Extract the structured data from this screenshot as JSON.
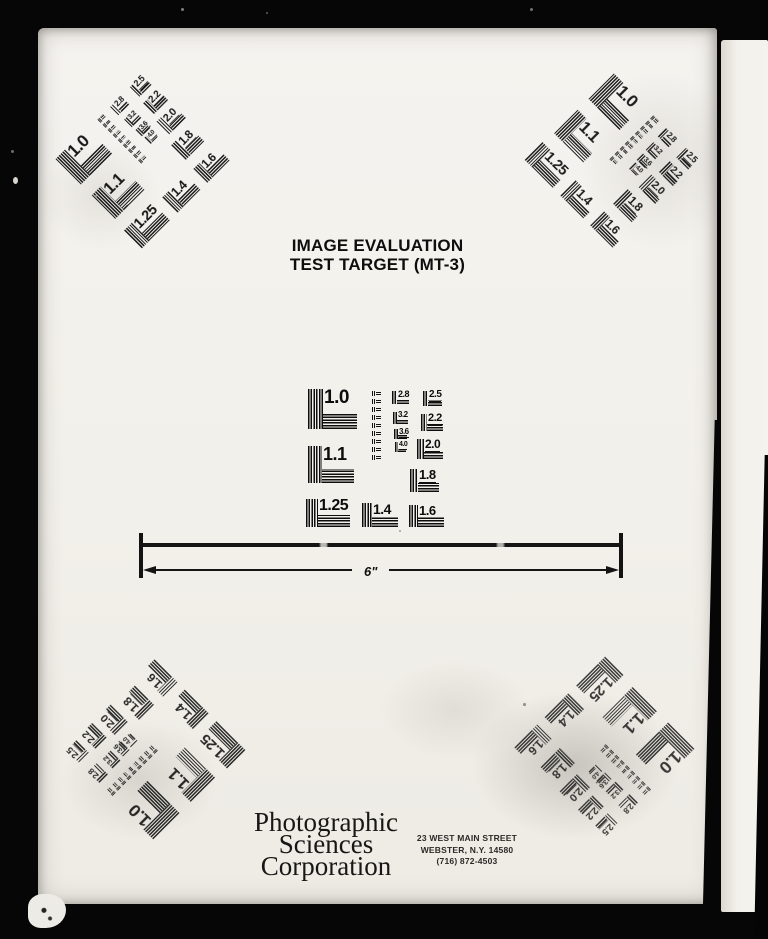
{
  "document": {
    "kind": "Scanned microfilm resolution test target page",
    "title_line1": "IMAGE EVALUATION",
    "title_line2": "TEST TARGET (MT-3)",
    "ruler_label": "6\"",
    "company_line1": "Photographic",
    "company_line2": "Sciences",
    "company_line3": "Corporation",
    "address_line1": "23 WEST MAIN STREET",
    "address_line2": "WEBSTER, N.Y. 14580",
    "address_line3": "(716) 872-4503"
  },
  "colors": {
    "paper": "#f2f0eb",
    "ink": "#0d0d0d",
    "background": "#060606"
  },
  "target_pattern": {
    "big_labels": [
      "1.0",
      "1.1",
      "1.25",
      "1.4",
      "1.6"
    ],
    "mid_labels": [
      "2.8",
      "3.2",
      "3.6",
      "4.0"
    ],
    "right_labels": [
      "2.5",
      "2.2",
      "2.0",
      "1.8"
    ],
    "micro_marks": 9,
    "micro_x": 66,
    "micro_y": 12,
    "micro_step": 8,
    "patches": [
      {
        "l": "1.0",
        "x": 2,
        "y": 10,
        "vw": 15,
        "vh": 40,
        "fs": 19,
        "hw": 34,
        "hh": 16,
        "u": 0
      },
      {
        "l": "1.1",
        "x": 2,
        "y": 67,
        "vw": 14,
        "vh": 37,
        "fs": 18,
        "hw": 32,
        "hh": 14,
        "u": 0
      },
      {
        "l": "1.25",
        "x": 0,
        "y": 120,
        "vw": 12,
        "vh": 28,
        "fs": 16,
        "hw": 32,
        "hh": 12,
        "u": 0
      },
      {
        "l": "1.4",
        "x": 56,
        "y": 124,
        "vw": 10,
        "vh": 24,
        "fs": 14,
        "hw": 26,
        "hh": 10,
        "u": 0
      },
      {
        "l": "1.6",
        "x": 103,
        "y": 126,
        "vw": 9,
        "vh": 22,
        "fs": 13,
        "hw": 26,
        "hh": 10,
        "u": 0
      },
      {
        "l": "2.8",
        "x": 86,
        "y": 12,
        "vw": 5,
        "vh": 13,
        "fs": 9,
        "hw": 12,
        "hh": 5,
        "u": 1
      },
      {
        "l": "3.2",
        "x": 87,
        "y": 33,
        "vw": 4,
        "vh": 12,
        "fs": 8,
        "hw": 11,
        "hh": 4,
        "u": 1
      },
      {
        "l": "3.6",
        "x": 88,
        "y": 50,
        "vw": 4,
        "vh": 10,
        "fs": 8,
        "hw": 9,
        "hh": 4,
        "u": 1
      },
      {
        "l": "4.0",
        "x": 89,
        "y": 63,
        "vw": 3,
        "vh": 10,
        "fs": 7,
        "hw": 8,
        "hh": 3,
        "u": 1
      },
      {
        "l": "2.5",
        "x": 117,
        "y": 12,
        "vw": 5,
        "vh": 15,
        "fs": 10,
        "hw": 14,
        "hh": 6,
        "u": 1
      },
      {
        "l": "2.2",
        "x": 115,
        "y": 35,
        "vw": 6,
        "vh": 17,
        "fs": 11,
        "hw": 16,
        "hh": 7,
        "u": 1
      },
      {
        "l": "2.0",
        "x": 111,
        "y": 60,
        "vw": 7,
        "vh": 20,
        "fs": 12,
        "hw": 19,
        "hh": 8,
        "u": 1
      },
      {
        "l": "1.8",
        "x": 104,
        "y": 90,
        "vw": 8,
        "vh": 23,
        "fs": 13,
        "hw": 21,
        "hh": 9,
        "u": 1
      }
    ]
  },
  "targets": [
    {
      "id": "top-left",
      "rotation_deg": -45,
      "cx": 140,
      "cy": 156,
      "scale": 0.9,
      "opacity": 0.95
    },
    {
      "id": "top-right",
      "rotation_deg": 45,
      "cx": 617,
      "cy": 158,
      "scale": 0.9,
      "opacity": 0.93
    },
    {
      "id": "center",
      "rotation_deg": 0,
      "cx": 377,
      "cy": 453,
      "scale": 1,
      "opacity": 1
    },
    {
      "id": "bottom-left",
      "rotation_deg": -135,
      "cx": 150,
      "cy": 752,
      "scale": 0.93,
      "opacity": 0.88
    },
    {
      "id": "bottom-right",
      "rotation_deg": 135,
      "cx": 607,
      "cy": 752,
      "scale": 0.93,
      "opacity": 0.8
    }
  ]
}
